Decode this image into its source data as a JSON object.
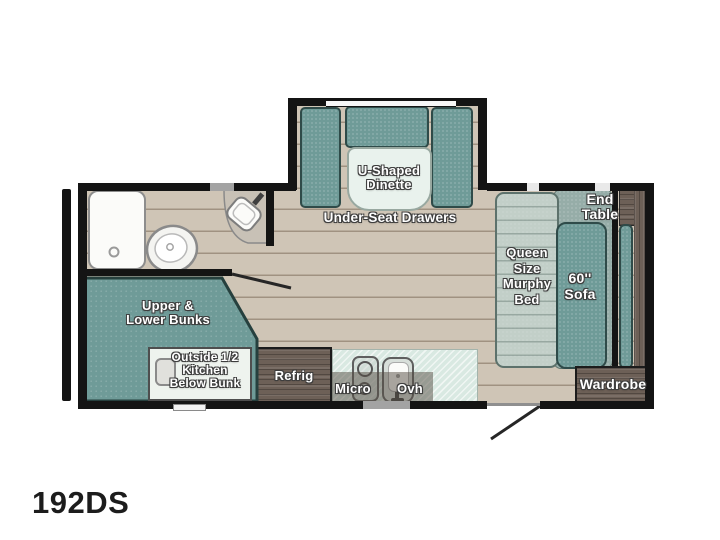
{
  "floorplan": {
    "model": "192DS",
    "type_hint": "travel-trailer-floorplan",
    "colors": {
      "cushion_teal": "#6f9b98",
      "bed_sage": "#c2cfc8",
      "wood_brown": "#6d6057",
      "counter_mint": "#d9e9e2",
      "floor_tan": "#cfc5b6",
      "wall_black": "#141414"
    },
    "dinette": {
      "name_lines": [
        "U-Shaped",
        "Dinette"
      ],
      "drawers_label": "Under-Seat Drawers"
    },
    "bedroom": {
      "bed_lines": [
        "Queen",
        "Size",
        "Murphy",
        "Bed"
      ],
      "sofa_lines": [
        "60''",
        "Sofa"
      ],
      "end_table_lines": [
        "End",
        "Table"
      ],
      "wardrobe": "Wardrobe"
    },
    "bunks": {
      "name_lines": [
        "Upper &",
        "Lower Bunks"
      ],
      "outside_kitchen_lines": [
        "Outside 1/2",
        "Kitchen",
        "Below Bunk"
      ]
    },
    "kitchen": {
      "refrigerator": "Refrig",
      "microwave": "Micro",
      "overhead": "Ovh"
    }
  }
}
